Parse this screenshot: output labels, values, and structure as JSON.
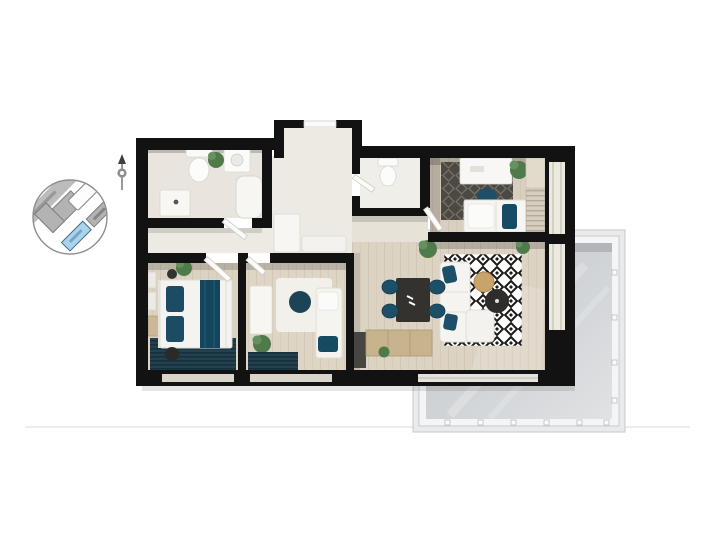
{
  "scene": {
    "type": "apartment-floor-plan-3d-top-view",
    "background": "#ffffff",
    "has_text_labels": false
  },
  "colors": {
    "wall": "#121212",
    "wood_floor": "#dcd3c3",
    "tile_floor": "#e9e5de",
    "hall_floor": "#edeae3",
    "accent_teal": "#1d5068",
    "accent_teal_dark": "#14455c",
    "rug_dark": "#4c4842",
    "rug_bw_ink": "#1c1a18",
    "balcony_floor": "#cdd0d3",
    "balcony_frame": "#f4f5f6",
    "minimap_road": "#bcbcbc",
    "minimap_building": "#b3b3b3",
    "minimap_highlight": "#a9d4ee",
    "plant_green": "#4f7a4a",
    "furniture_white": "#f5f4f1",
    "table_dark": "#33322f",
    "wood_cabinet": "#c7b38c"
  },
  "minimap": {
    "shape": "circle",
    "description": "site location plan",
    "roads": [
      {
        "id": "street-band",
        "label_visible": true,
        "label_legible": false
      }
    ],
    "buildings": [
      {
        "id": "building-outline",
        "style": "white-outline",
        "highlighted": false
      },
      {
        "id": "building-gray-large",
        "style": "gray",
        "highlighted": false
      },
      {
        "id": "building-gray-small",
        "style": "gray",
        "highlighted": false
      },
      {
        "id": "building-current",
        "style": "filled",
        "highlighted": true,
        "color": "#a9d4ee"
      }
    ],
    "compass": {
      "type": "north-needle"
    }
  },
  "floor_plan": {
    "rooms": [
      {
        "id": "entry-vestibule",
        "furniture": [
          "entrance-door"
        ]
      },
      {
        "id": "bathroom",
        "furniture": [
          "toilet",
          "washing-machine",
          "plant",
          "bathtub",
          "vanity-sink"
        ]
      },
      {
        "id": "wc",
        "furniture": [
          "toilet",
          "door"
        ]
      },
      {
        "id": "hallway",
        "furniture": [
          "built-in-wardrobe",
          "bench-cabinet"
        ]
      },
      {
        "id": "bedroom-top-right",
        "furniture": [
          "ceiling-lamp",
          "desk",
          "dark-diamond-rug",
          "teal-pouf",
          "plant",
          "double-bed",
          "teal-pillow",
          "striped-wardrobe"
        ]
      },
      {
        "id": "bedroom-left",
        "furniture": [
          "double-bed",
          "teal-runner",
          "teal-pillows",
          "round-nightstand",
          "round-pouf",
          "plant",
          "wall-frames",
          "wood-dresser",
          "striped-rug"
        ]
      },
      {
        "id": "bedroom-middle",
        "furniture": [
          "white-dresser-desk",
          "white-rug",
          "teal-pouf",
          "daybed",
          "teal-pillow",
          "plant",
          "striped-rug"
        ]
      },
      {
        "id": "living-dining-kitchen",
        "furniture": [
          "dining-table",
          "dining-chairs-x4",
          "sofa",
          "chaise",
          "round-coffee-table-tan",
          "round-coffee-table-black",
          "bw-diamond-rug",
          "kitchen-dark-unit",
          "wood-sideboard",
          "plants"
        ]
      },
      {
        "id": "balcony",
        "furniture": [
          "tiled-floor",
          "railing-frame"
        ]
      }
    ],
    "window_count": 5,
    "door_count": 6
  }
}
